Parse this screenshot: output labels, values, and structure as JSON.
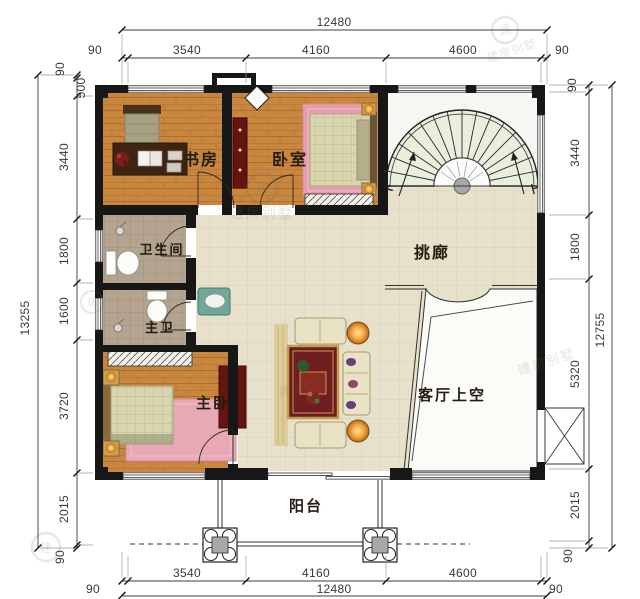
{
  "rooms": {
    "study": "书房",
    "bedroom": "卧室",
    "bathroom": "卫生间",
    "master_bath": "主卫",
    "master_bedroom": "主卧",
    "corridor": "挑廊",
    "living_void": "客厅上空",
    "balcony": "阳台"
  },
  "stairs": {
    "down": "下",
    "up": "上"
  },
  "dims": {
    "top": {
      "overall": "12480",
      "seg": [
        "90",
        "3540",
        "4160",
        "4600",
        "90"
      ]
    },
    "bottom": {
      "overall": "12480",
      "seg": [
        "90",
        "3540",
        "4160",
        "4600",
        "90"
      ]
    },
    "left": {
      "overall": "13255",
      "seg": [
        "90",
        "500",
        "3440",
        "1800",
        "1600",
        "3720",
        "2015",
        "90"
      ]
    },
    "right": {
      "overall": "12755",
      "seg": [
        "90",
        "3440",
        "1800",
        "5320",
        "2015",
        "90"
      ]
    }
  },
  "watermark": {
    "text": "建房别墅",
    "logo_char": "建"
  },
  "colors": {
    "wall": "#171717",
    "wood_floor": "#c8863e",
    "corridor_tile": "#e7e0cb",
    "bath_floor": "#b4a38e",
    "stair_tread": "#e9eedd",
    "rug_pink": "#e59cad",
    "rug_red": "#701d22",
    "accent_gold": "#c59b4e",
    "lamp_orange": "#f59d2f",
    "vanity_teal": "#6fa899",
    "cabinet_maroon": "#6a1511"
  }
}
